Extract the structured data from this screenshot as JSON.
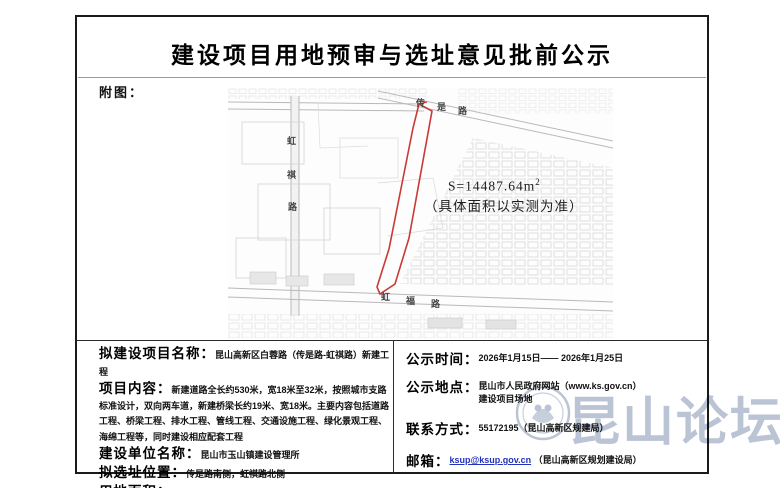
{
  "page": {
    "title": "建设项目用地预审与选址意见批前公示",
    "figure_label": "附图："
  },
  "map": {
    "area_value": "S=14487.64m",
    "area_sup": "2",
    "area_note": "（具体面积以实测为准）",
    "roads": {
      "chuanshi": [
        "传",
        "是",
        "路"
      ],
      "hongqi": [
        "虹",
        "祺",
        "路"
      ],
      "hongfu": [
        "虹",
        "福",
        "路"
      ]
    }
  },
  "details_left": {
    "project_name_label": "拟建设项目名称：",
    "project_name": "昆山高新区白蓉路（传是路-虹祺路）新建工程",
    "content_label": "项目内容：",
    "content": "新建道路全长约530米，宽18米至32米，按照城市支路标准设计，双向两车道，新建桥梁长约19米、宽18米。主要内容包括道路工程、桥梁工程、排水工程、管线工程、交通设施工程、绿化景观工程、海绵工程等，同时建设相应配套工程",
    "unit_label": "建设单位名称：",
    "unit": "昆山市玉山镇建设管理所",
    "location_label": "拟选址位置：",
    "location": "传是路南侧，虹祺路北侧",
    "area_label": "用地面积：",
    "area": "14487.64平方米"
  },
  "details_right": {
    "time_label": "公示时间：",
    "time": "2026年1月15日—— 2026年1月25日",
    "place_label": "公示地点：",
    "place_line1": "昆山市人民政府网站（www.ks.gov.cn）",
    "place_line2": "建设项目场地",
    "contact_label": "联系方式：",
    "contact": "55172195（昆山高新区规建局）",
    "email_label": "邮箱：",
    "email": "ksup@ksup.gov.cn",
    "email_note": "（昆山高新区规划建设局）"
  },
  "watermark": {
    "text": "昆山论坛"
  },
  "colors": {
    "parcel_red": "#c93a35",
    "watermark": "#b6c1d3",
    "link_blue": "#2233bb"
  }
}
